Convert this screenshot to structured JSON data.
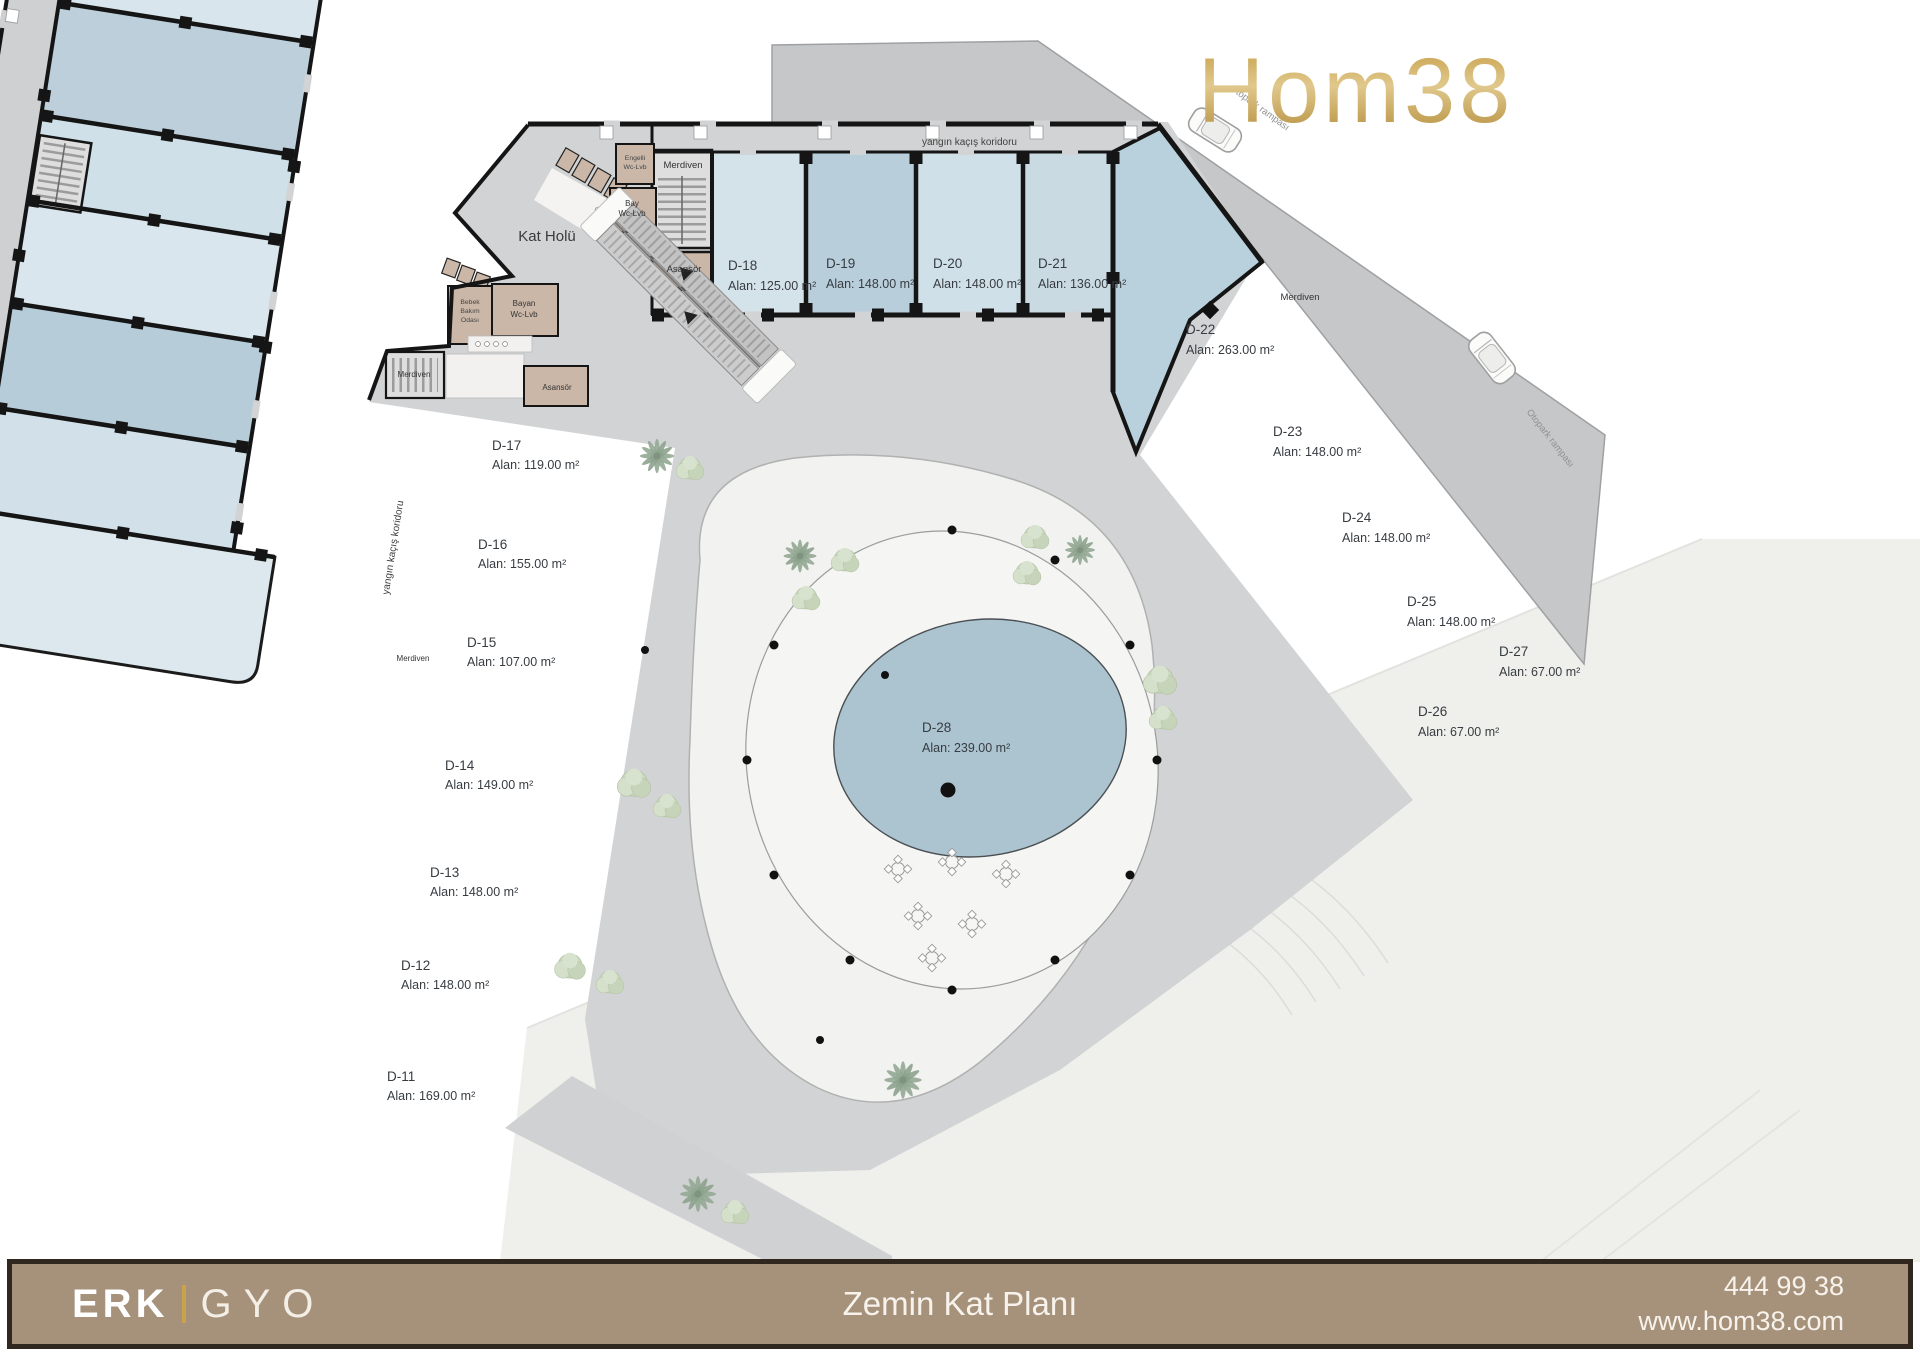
{
  "logo": {
    "text": "Hom38"
  },
  "plan": {
    "units": [
      {
        "id": "D-11",
        "area": "Alan: 169.00 m²"
      },
      {
        "id": "D-12",
        "area": "Alan: 148.00 m²"
      },
      {
        "id": "D-13",
        "area": "Alan: 148.00 m²"
      },
      {
        "id": "D-14",
        "area": "Alan: 149.00 m²"
      },
      {
        "id": "D-15",
        "area": "Alan: 107.00 m²"
      },
      {
        "id": "D-16",
        "area": "Alan: 155.00 m²"
      },
      {
        "id": "D-17",
        "area": "Alan: 119.00 m²"
      },
      {
        "id": "D-18",
        "area": "Alan: 125.00 m²"
      },
      {
        "id": "D-19",
        "area": "Alan: 148.00 m²"
      },
      {
        "id": "D-20",
        "area": "Alan: 148.00 m²"
      },
      {
        "id": "D-21",
        "area": "Alan: 136.00 m²"
      },
      {
        "id": "D-22",
        "area": "Alan: 263.00 m²"
      },
      {
        "id": "D-23",
        "area": "Alan: 148.00 m²"
      },
      {
        "id": "D-24",
        "area": "Alan: 148.00 m²"
      },
      {
        "id": "D-25",
        "area": "Alan: 148.00 m²"
      },
      {
        "id": "D-26",
        "area": "Alan: 67.00 m²"
      },
      {
        "id": "D-27",
        "area": "Alan: 67.00 m²"
      },
      {
        "id": "D-28",
        "area": "Alan: 239.00 m²"
      }
    ],
    "labels": {
      "kat_holu": "Kat Holü",
      "merdiven": "Merdiven",
      "asansor": "Asansör",
      "fire_corridor": "yangın kaçış koridoru",
      "otopark_ramp": "Otopark rampası",
      "wc_engelli": [
        "Engelli",
        "Wc-Lvb"
      ],
      "wc_bay": [
        "Bay",
        "Wc-Lvb"
      ],
      "wc_bayan": [
        "Bayan",
        "Wc-Lvb"
      ],
      "bebek": [
        "Bebek",
        "Bakım",
        "Odası"
      ]
    }
  },
  "footer": {
    "brand_left": "ERK",
    "brand_right": "GYO",
    "title": "Zemin Kat Planı",
    "phone": "444 99 38",
    "website": "www.hom38.com"
  },
  "colors": {
    "gold": "#c8a350",
    "footer_bg": "#a6917a",
    "unit_blue_light": "#d5e3ea",
    "unit_blue_dark": "#b7cedb",
    "pool": "#abc4d0"
  }
}
